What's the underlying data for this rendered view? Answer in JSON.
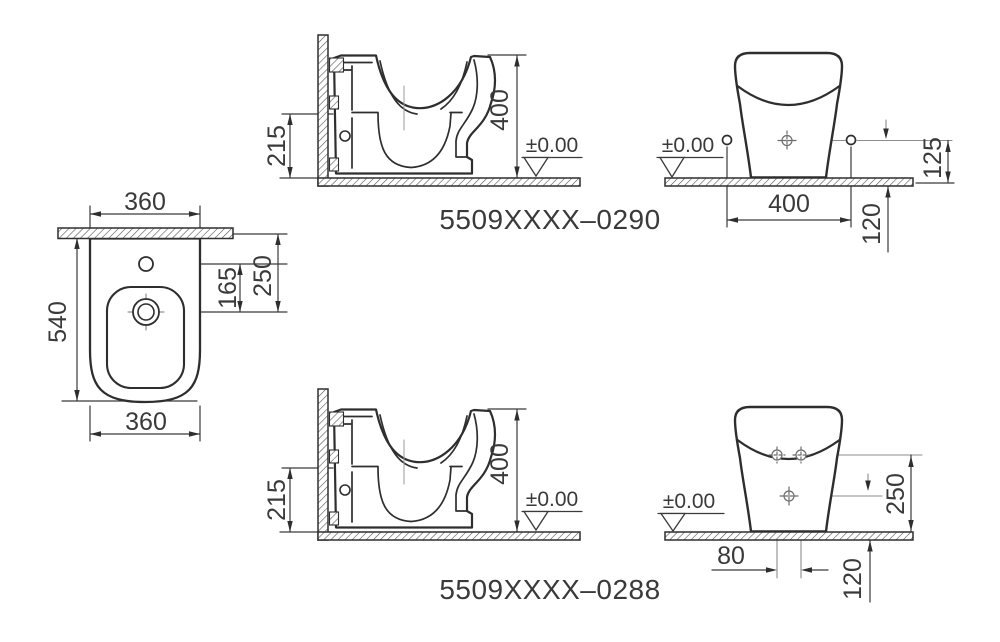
{
  "page": {
    "background": "#ffffff",
    "line_color": "#2e2e2e"
  },
  "plan_view": {
    "dim_width_top": "360",
    "dim_depth": "540",
    "dim_tap_to_drain": "165",
    "dim_wall_to_drain": "250",
    "dim_width_bottom": "360"
  },
  "model_top": {
    "code": "5509XXXX–0290",
    "section": {
      "dim_inlet_height": "215",
      "dim_rim_height": "400",
      "datum_label": "±0.00"
    },
    "rear": {
      "dim_fixing_span": "400",
      "dim_outlet_offset": "120",
      "dim_fixing_height": "125",
      "datum_label": "±0.00"
    }
  },
  "model_bottom": {
    "code": "5509XXXX–0288",
    "section": {
      "dim_inlet_height": "215",
      "dim_rim_height": "400",
      "datum_label": "±0.00"
    },
    "rear": {
      "dim_hole_span": "80",
      "dim_outlet_offset": "120",
      "dim_supply_height": "250",
      "datum_label": "±0.00"
    }
  }
}
